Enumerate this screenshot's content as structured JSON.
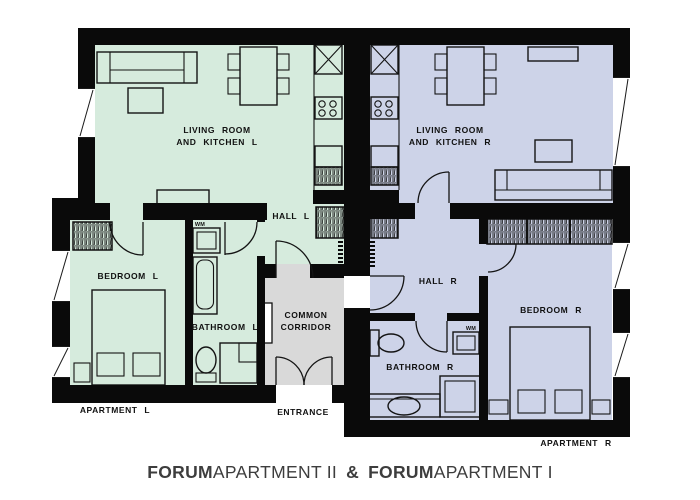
{
  "colors": {
    "apartment_left": "#d6ebdd",
    "apartment_right": "#cdd3e8",
    "corridor": "#d9d9d9",
    "wall": "#0a0a0a",
    "furniture_line": "#141414",
    "label_text": "#101010",
    "title_text": "#3d3d3d",
    "background": "#ffffff"
  },
  "title": {
    "brand_1": "FORUM",
    "name_1": "APARTMENT II",
    "separator": "&",
    "brand_2": "FORUM",
    "name_2": "APARTMENT I"
  },
  "apartment_left": {
    "label": "APARTMENT L",
    "living_room_line_1": "LIVING ROOM",
    "living_room_line_2": "AND KITCHEN L",
    "hall": "HALL L",
    "bedroom": "BEDROOM L",
    "bathroom": "BATHROOM L",
    "washing_machine": "WM"
  },
  "apartment_right": {
    "label": "APARTMENT R",
    "living_room_line_1": "LIVING ROOM",
    "living_room_line_2": "AND KITCHEN R",
    "hall": "HALL R",
    "bedroom": "BEDROOM R",
    "bathroom": "BATHROOM R",
    "washing_machine": "WM"
  },
  "common": {
    "corridor_line_1": "COMMON",
    "corridor_line_2": "CORRIDOR",
    "entrance": "ENTRANCE"
  }
}
